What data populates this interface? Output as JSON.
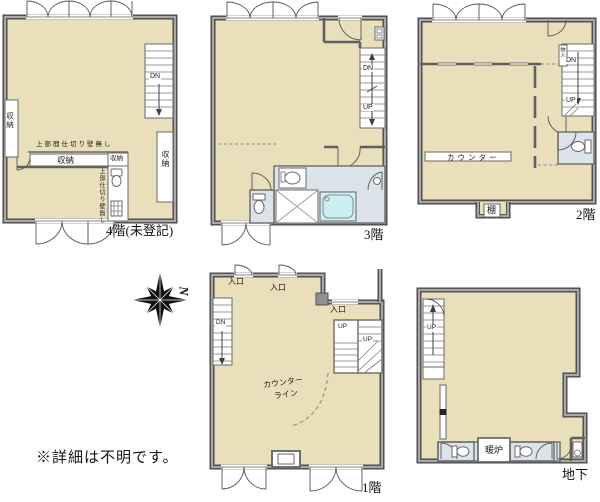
{
  "sheet": {
    "note": "※詳細は不明です。",
    "compass_n": "N"
  },
  "palette": {
    "floor": "#e9dfbb",
    "wet_area": "#dde3ea",
    "bathtub": "#cdeef2",
    "wall": "#4a4a4a"
  },
  "plans": {
    "f4": {
      "title": "4階(未登記)",
      "labels": {
        "dn": "DN",
        "closet": "収納",
        "no_partition_h": "上部間仕切り壁無し",
        "no_partition_v": "上部仕切り壁無し"
      }
    },
    "f3": {
      "title": "3階",
      "labels": {
        "dn": "DN",
        "up": "UP"
      }
    },
    "f2": {
      "title": "2階",
      "labels": {
        "dn": "DN",
        "up": "UP",
        "counter": "カウンター",
        "shelf": "棚",
        "storage_small": "物入"
      }
    },
    "f1": {
      "title": "1階",
      "labels": {
        "dn": "DN",
        "up": "UP",
        "entrance": "入口",
        "counter_line_1": "カウンター",
        "counter_line_2": "ライン"
      }
    },
    "b1": {
      "title": "地下",
      "labels": {
        "up": "UP",
        "fireplace": "暖炉"
      }
    }
  }
}
